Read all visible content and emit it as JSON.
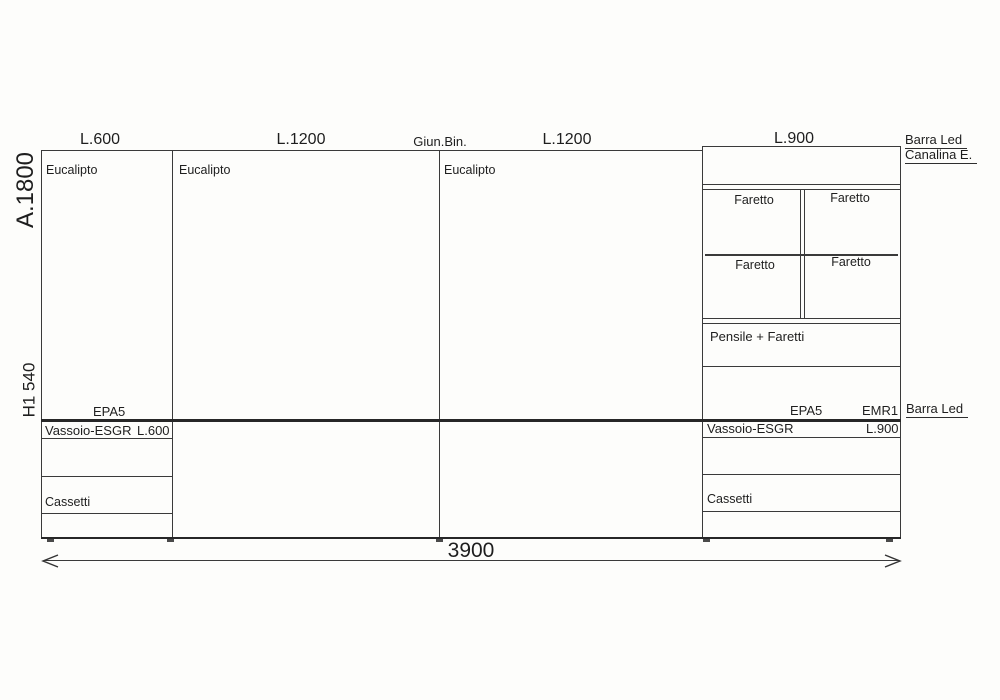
{
  "top_labels": [
    {
      "label": "L.600"
    },
    {
      "label": "L.1200"
    },
    {
      "label": "Giun.Bin."
    },
    {
      "label": "L.1200"
    },
    {
      "label": "L.900"
    }
  ],
  "side_labels": {
    "height": "A.1800",
    "h1": "H1 540"
  },
  "material_labels": [
    "Eucalipto",
    "Eucalipto",
    "Eucalipto"
  ],
  "pensile": {
    "faretto_tl": "Faretto",
    "faretto_tr": "Faretto",
    "faretto_bl": "Faretto",
    "faretto_br": "Faretto",
    "label": "Pensile + Faretti"
  },
  "annotations": {
    "barra_led_top": "Barra Led",
    "canalina": "Canalina E.",
    "barra_led_mid": "Barra Led",
    "epa5_left": "EPA5",
    "epa5_right": "EPA5",
    "emr1": "EMR1"
  },
  "lower_left": {
    "vassoio": "Vassoio-ESGR",
    "size": "L.600",
    "cassetti": "Cassetti"
  },
  "lower_right": {
    "vassoio": "Vassoio-ESGR",
    "size": "L.900",
    "cassetti": "Cassetti"
  },
  "dimension": {
    "total_width": "3900"
  }
}
